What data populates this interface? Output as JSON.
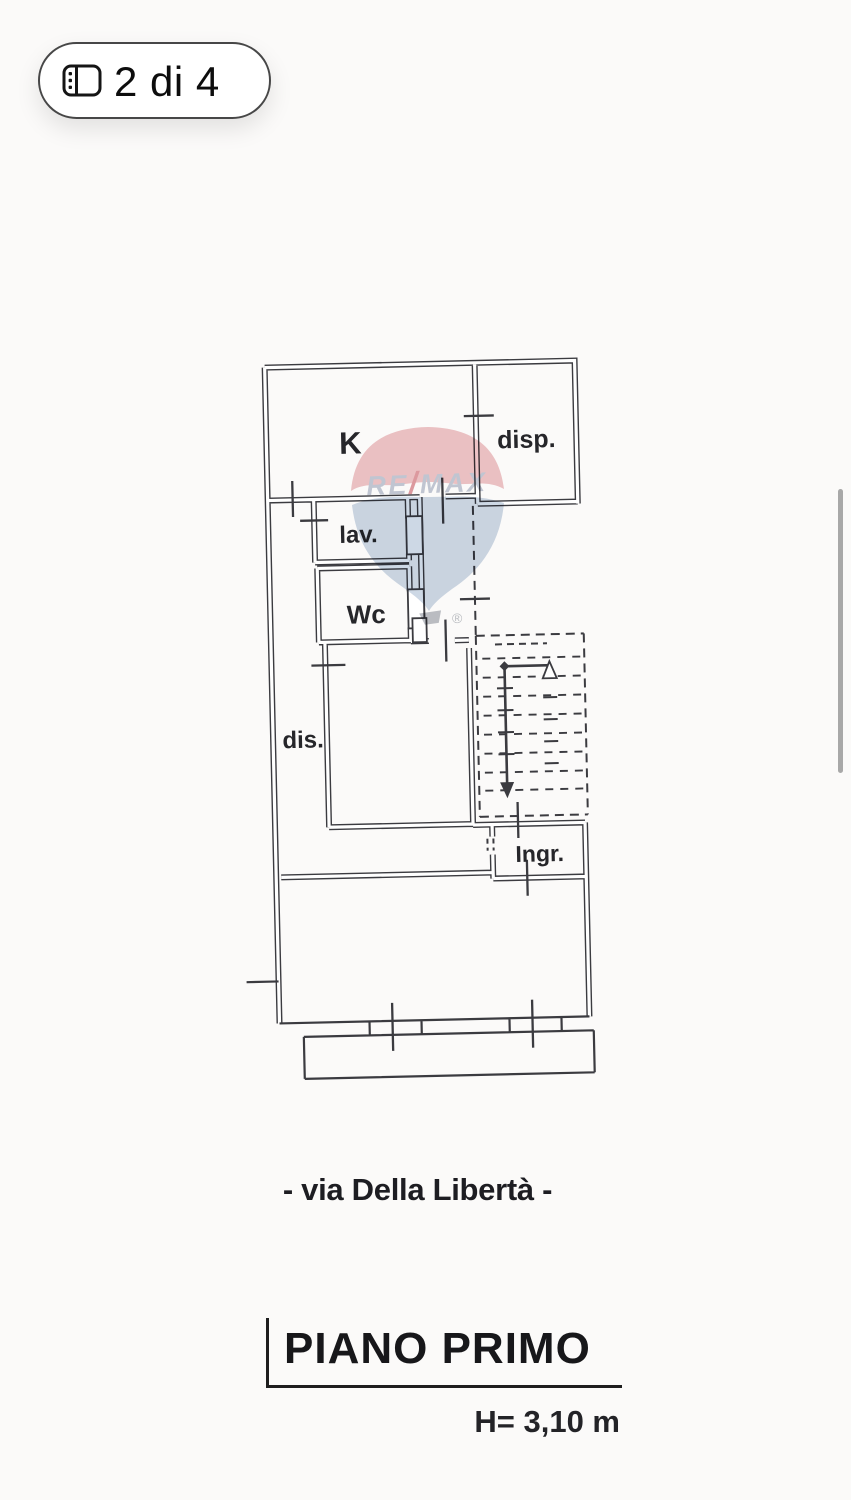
{
  "viewer": {
    "badge": {
      "label": "2 di 4",
      "icon": "gallery-icon"
    }
  },
  "floorplan": {
    "rooms": {
      "k": "K",
      "disp": "disp.",
      "lav": "lav.",
      "wc": "Wc",
      "dis": "dis.",
      "ingr": "Ingr."
    },
    "watermark": {
      "re": "RE",
      "slash": "/",
      "max": "MAX",
      "registered": "®"
    },
    "caption": {
      "street": "- via Della Libertà -",
      "floor": "PIANO PRIMO",
      "height": "H= 3,10 m"
    },
    "colors": {
      "ink": "#3b3b40",
      "balloon_top": "#e2999f",
      "balloon_bottom": "#a9bbd3",
      "brand_text": "#98a1b8",
      "brand_slash": "#c9545e",
      "scroll_thumb": "#a8a8a8"
    }
  }
}
